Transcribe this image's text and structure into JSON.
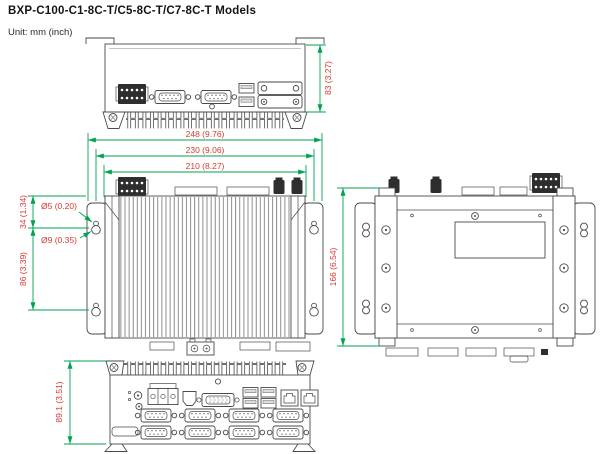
{
  "page": {
    "title": "BXP-C100-C1-8C-T/C5-8C-T/C7-8C-T Models",
    "unit_label": "Unit: mm (inch)"
  },
  "colors": {
    "dimension_line": "#00A350",
    "dimension_text": "#D53A2F",
    "drawing_line": "#4a4a4a"
  },
  "dimensions": {
    "top_height": "83 (3.27)",
    "overall_width": "248 (9.76)",
    "bracket_width": "230 (9.06)",
    "body_width": "210 (8.27)",
    "mount_hole_offset": "34 (1.34)",
    "mount_hole_small": "Ø5 (0.20)",
    "mount_hole_large": "Ø9 (0.35)",
    "mount_hole_spacing": "86 (3.39)",
    "rear_height": "166 (6.54)",
    "front_panel_height": "89.1 (3.51)"
  }
}
